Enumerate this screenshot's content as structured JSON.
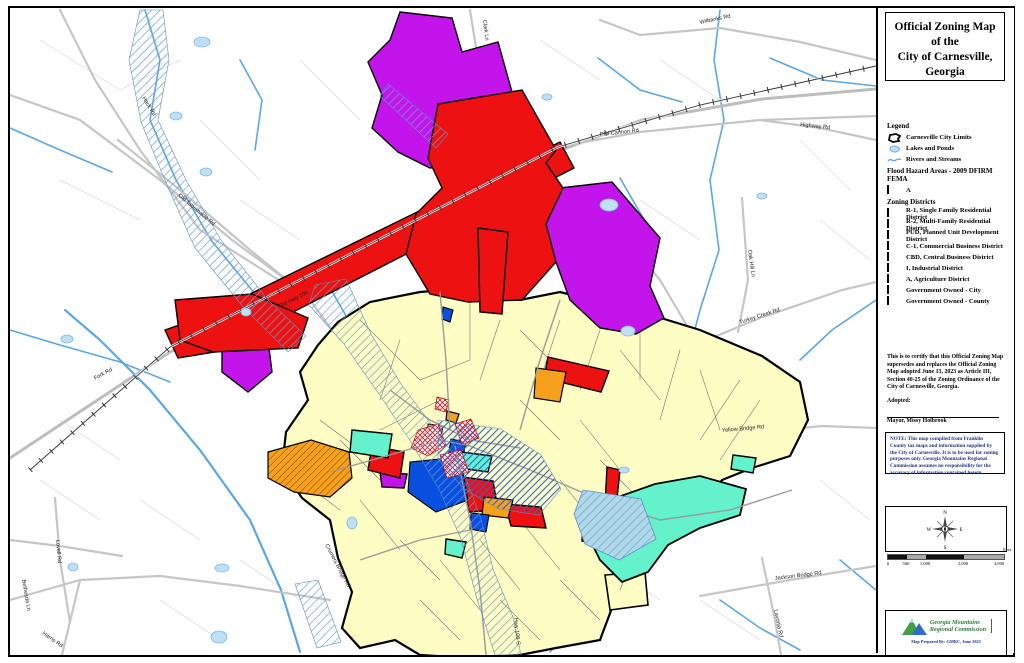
{
  "title": {
    "line1": "Official Zoning Map",
    "line2": "of the",
    "line3": "City of Carnesville, Georgia"
  },
  "legend": {
    "heading": "Legend",
    "items": [
      {
        "name": "city-limits",
        "label": "Carnesville City Limits"
      },
      {
        "name": "lakes-ponds",
        "label": "Lakes and Ponds"
      },
      {
        "name": "rivers-streams",
        "label": "Rivers and Streams"
      }
    ],
    "flood_heading": "Flood Hazard Areas - 2009 DFIRM FEMA",
    "flood_label": "A",
    "districts_heading": "Zoning Districts",
    "districts": [
      {
        "code": "R-1",
        "label": "R-1, Single Family Residential District",
        "color": "#FEFDC3"
      },
      {
        "code": "R-2",
        "label": "R-2, Multi-Family Residential District",
        "color": "#F7A01C"
      },
      {
        "code": "PUD",
        "label": "PUD, Planned Unit Development District",
        "color": "#D9A295"
      },
      {
        "code": "C-1",
        "label": "C-1, Commercial Business District",
        "color": "#EE1111"
      },
      {
        "code": "CBD",
        "label": "CBD, Central Business District",
        "color": "#FFFFFF"
      },
      {
        "code": "I",
        "label": "I, Industrial District",
        "color": "#C414EC"
      },
      {
        "code": "A",
        "label": "A, Agriculture District",
        "color": "#6CA21F"
      },
      {
        "code": "GOV-CITY",
        "label": "Government Owned - City",
        "color": "#0A50E0"
      },
      {
        "code": "GOV-COUNTY",
        "label": "Government Owned - County",
        "color": "#63F2CC"
      }
    ]
  },
  "certification": {
    "text": "This is to certify that this Official Zoning Map supersedes and replaces the Official Zoning Map adopted June 13, 2023 as Article III, Section 40-25 of the Zoning Ordinance of the City of Carnesville, Georgia.",
    "adopted_label": "Adopted:",
    "mayor": "Mayor, Missy Holbrook",
    "clerk": "City Clerk, Dana Little"
  },
  "note": "NOTE: This map compiled from Franklin County tax maps and information supplied by the City of Carnesville. It is to be used for zoning purposes only. Georgia Mountains Regional Commission assumes no responsibility for the accuracy of information contained herein.",
  "compass": {
    "n": "N",
    "e": "E",
    "s": "S",
    "w": "W"
  },
  "scale_bar": {
    "labels": [
      "0",
      "500",
      "1,000",
      "2,000",
      "3,000"
    ],
    "unit": "Feet"
  },
  "logo": {
    "org_line1": "Georgia Mountains",
    "org_line2": "Regional Commission",
    "credit": "Map Prepared By: GMRC, June 2023"
  },
  "map": {
    "colors": {
      "r1": "#FEFDC3",
      "r2": "#F7A01C",
      "pud": "#D9A295",
      "c1": "#EE1111",
      "industrial": "#C414EC",
      "agriculture": "#6CA21F",
      "gov_city": "#0A50E0",
      "gov_county": "#63F2CC",
      "water": "#5AA7E4",
      "flood_hatch": "#7FA8D0"
    },
    "road_labels": [
      {
        "label": "Wilbanks Rd"
      },
      {
        "label": "Clark Ln"
      },
      {
        "label": "Hack Rd"
      },
      {
        "label": "Phil Cannon Rd"
      },
      {
        "label": "Highway Rd"
      },
      {
        "label": "Old Tabernacle Rd"
      },
      {
        "label": "Oak Hill Ln"
      },
      {
        "label": "Turkey Creek Rd"
      },
      {
        "label": "Yellow Bridge Rd"
      },
      {
        "label": "Jackson Bridge Rd"
      },
      {
        "label": "Lavonia Rd"
      },
      {
        "label": "Fork Rd"
      },
      {
        "label": "Lovell Rd"
      },
      {
        "label": "Bethesda Ln"
      },
      {
        "label": "Harris Rd"
      },
      {
        "label": "Cromers Bridge Rd"
      },
      {
        "label": "Hwy 106 S"
      },
      {
        "label": "Old Hwy 106"
      }
    ]
  }
}
